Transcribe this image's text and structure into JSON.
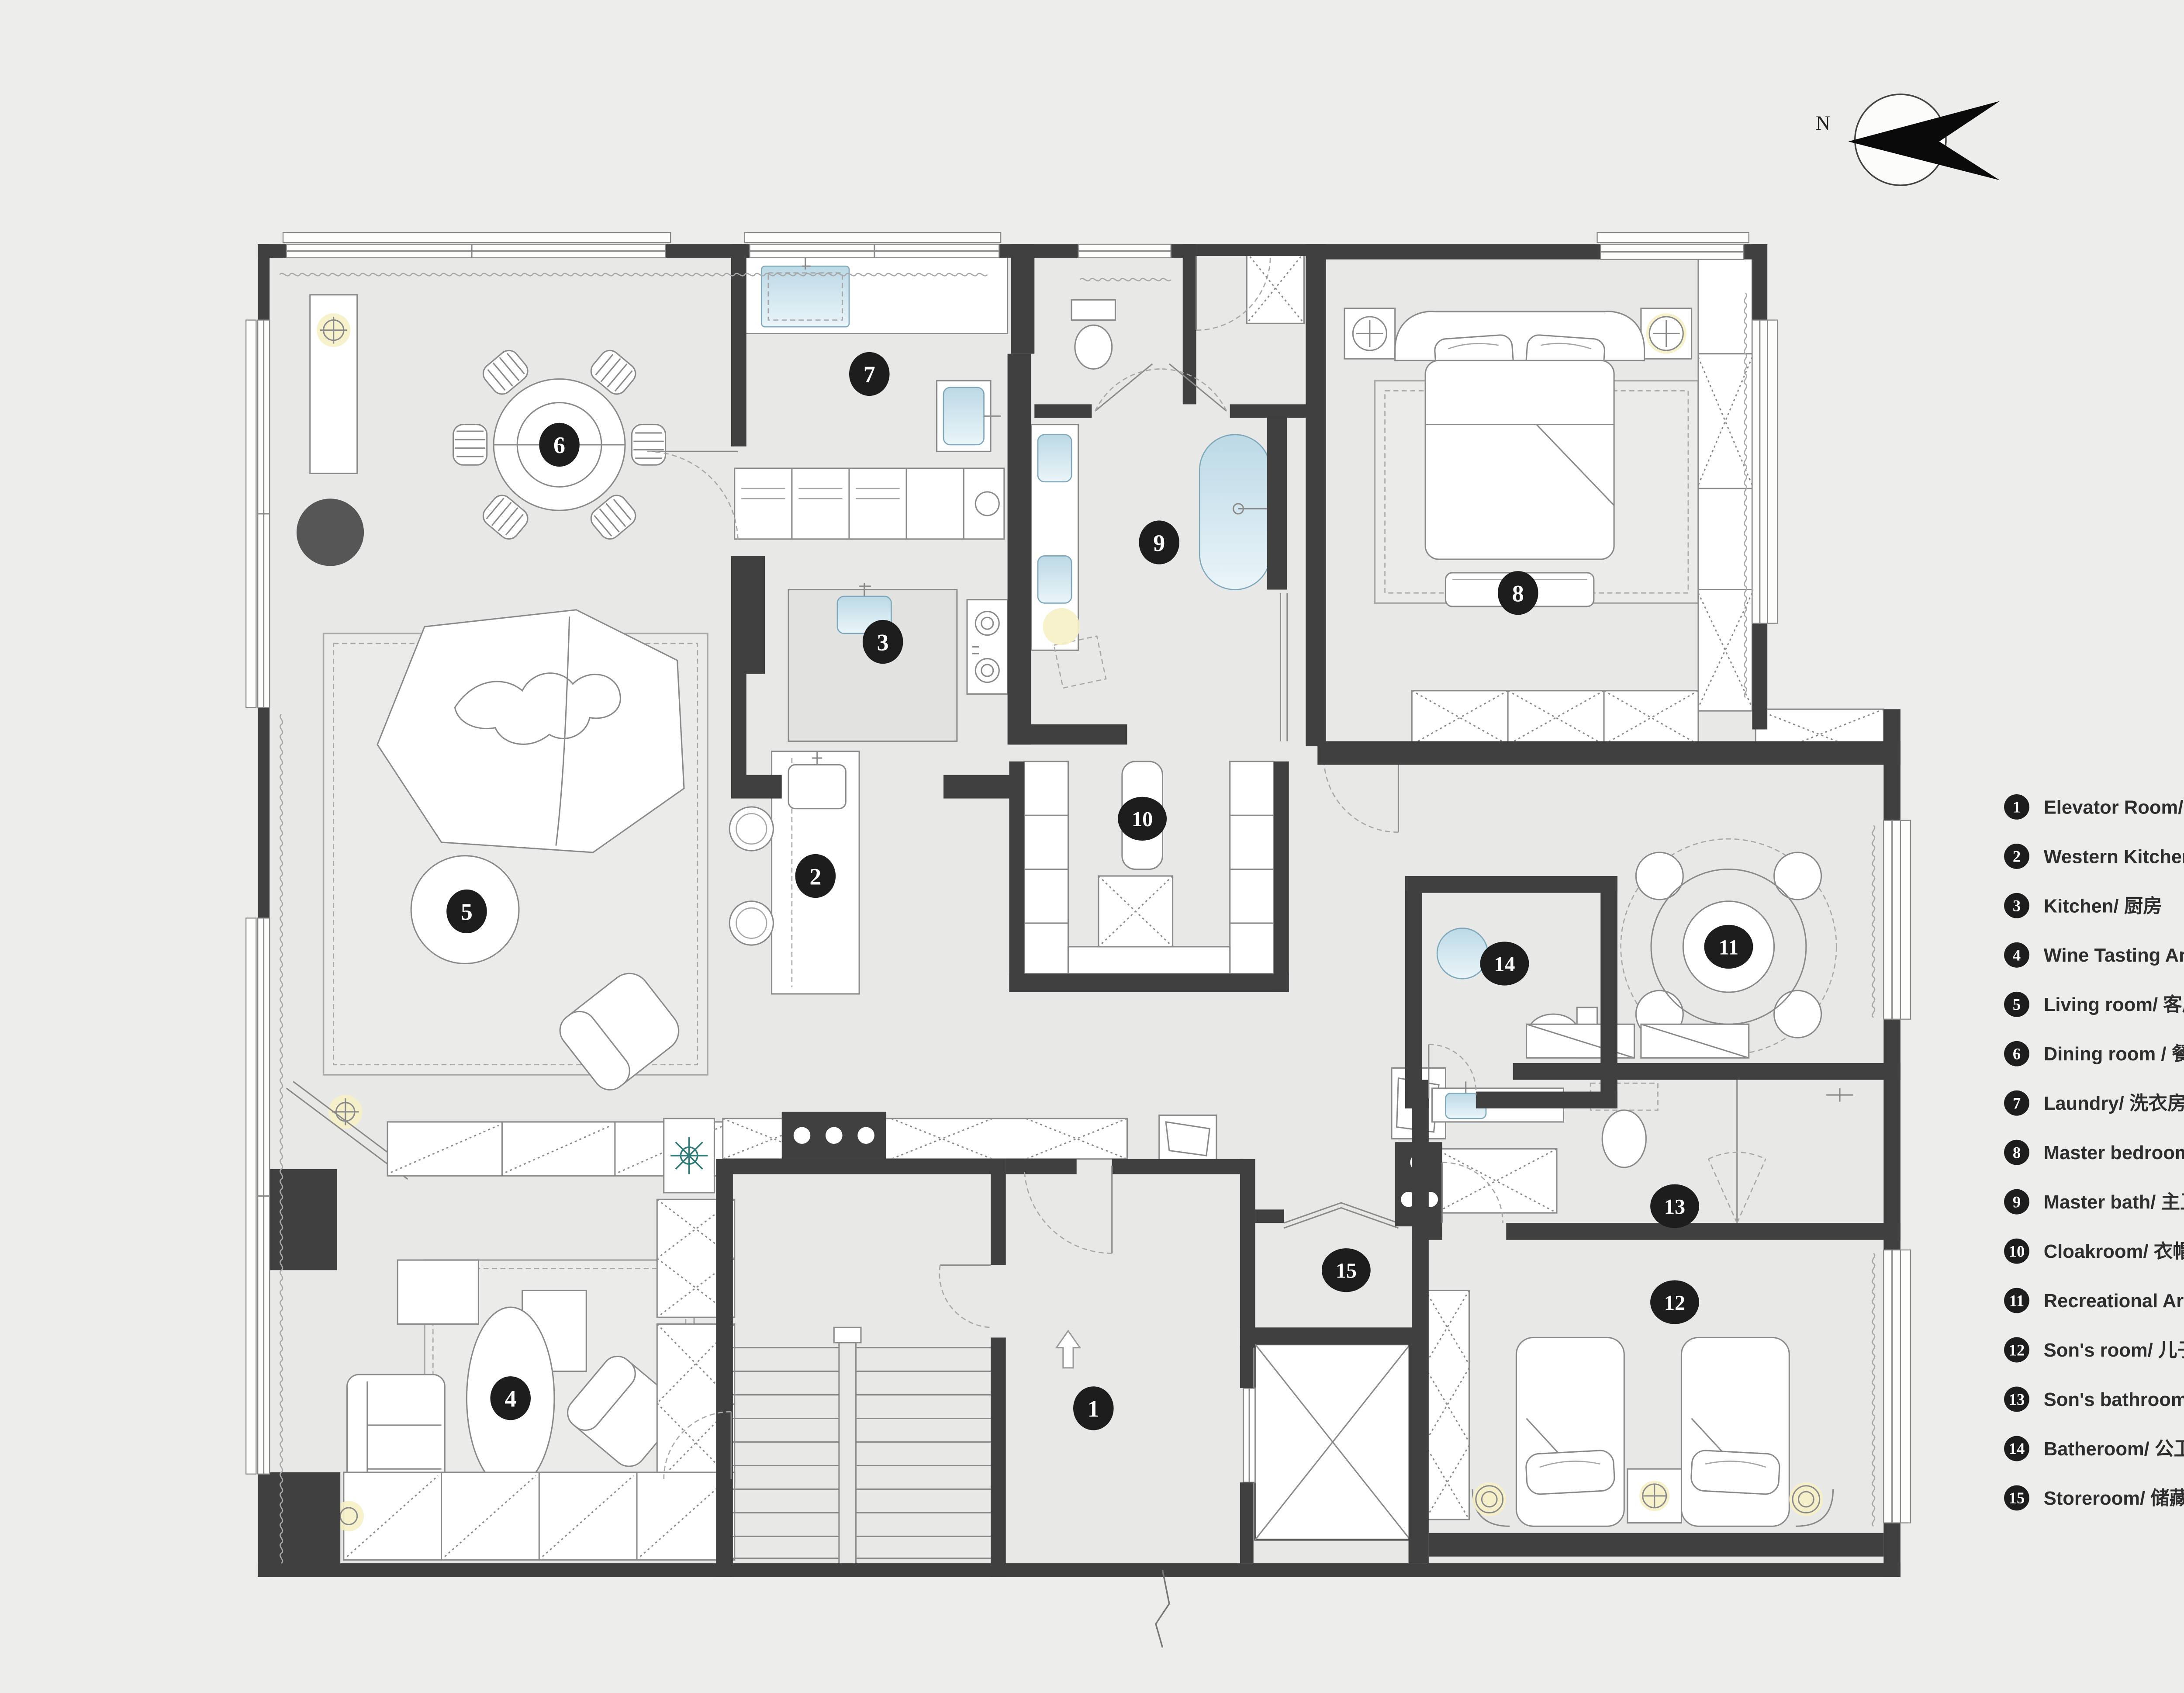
{
  "compass": {
    "label": "N"
  },
  "legend": {
    "items": [
      {
        "num": "1",
        "label": "Elevator Room/ 电梯间"
      },
      {
        "num": "2",
        "label": "Western Kitchen/ 西厨"
      },
      {
        "num": "3",
        "label": "Kitchen/ 厨房"
      },
      {
        "num": "4",
        "label": "Wine Tasting Area/ 品酒区"
      },
      {
        "num": "5",
        "label": "Living room/ 客厅"
      },
      {
        "num": "6",
        "label": "Dining room / 餐厅"
      },
      {
        "num": "7",
        "label": "Laundry/ 洗衣房"
      },
      {
        "num": "8",
        "label": "Master bedroom/ 主卧"
      },
      {
        "num": "9",
        "label": "Master bath/ 主卫"
      },
      {
        "num": "10",
        "label": "Cloakroom/ 衣帽间"
      },
      {
        "num": "11",
        "label": "Recreational Areas/ 休闲区"
      },
      {
        "num": "12",
        "label": "Son's room/ 儿子房"
      },
      {
        "num": "13",
        "label": "Son's bathroom/ 儿子卫生间"
      },
      {
        "num": "14",
        "label": "Batheroom/ 公卫"
      },
      {
        "num": "15",
        "label": "Storeroom/ 储藏室"
      }
    ]
  },
  "plan": {
    "badge_numbers": [
      "1",
      "2",
      "3",
      "4",
      "5",
      "6",
      "7",
      "8",
      "9",
      "10",
      "11",
      "12",
      "13",
      "14",
      "15"
    ]
  },
  "colors": {
    "background": "#ededeb",
    "floor": "#e8e8e6",
    "wall": "#404040",
    "badge": "#1d1d1d",
    "sink_blue": "#cfe4ee",
    "lamp_yellow": "#f6f1c6",
    "plant_teal": "#2f7a76",
    "legend_text": "#2d2d2d"
  }
}
